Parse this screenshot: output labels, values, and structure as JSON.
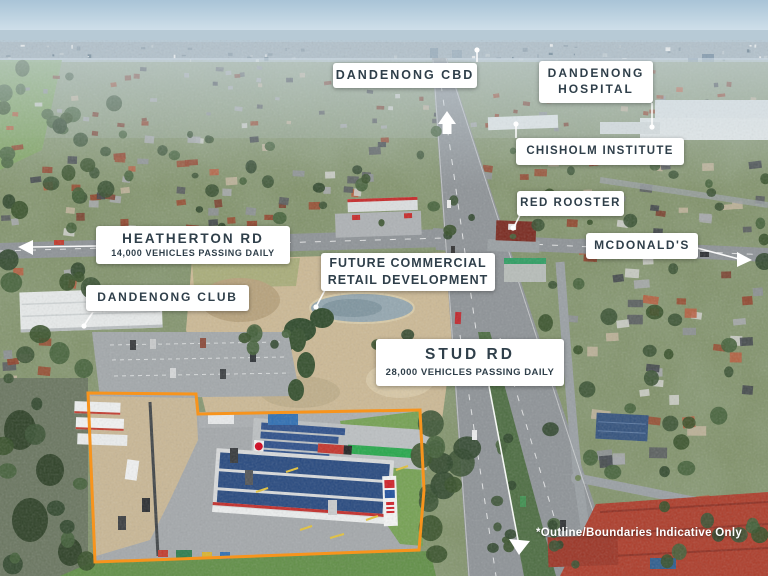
{
  "colors": {
    "boundary": "#F7941D",
    "label_bg": "#FFFFFF",
    "label_text": "#2F3F4A",
    "disclaimer_text": "#FFFFFF"
  },
  "labels": {
    "dandenong_cbd": {
      "text": "DANDENONG CBD"
    },
    "dandenong_hospital": {
      "line1": "DANDENONG",
      "line2": "HOSPITAL"
    },
    "chisholm_institute": {
      "text": "CHISHOLM INSTITUTE"
    },
    "red_rooster": {
      "text": "RED ROOSTER"
    },
    "mcdonalds": {
      "text": "MCDONALD'S"
    },
    "heatherton_rd": {
      "title": "HEATHERTON RD",
      "subtitle": "14,000 VEHICLES PASSING DAILY"
    },
    "dandenong_club": {
      "text": "DANDENONG CLUB"
    },
    "future_development": {
      "line1": "FUTURE COMMERCIAL",
      "line2": "RETAIL DEVELOPMENT"
    },
    "stud_rd": {
      "title": "STUD RD",
      "subtitle": "28,000 VEHICLES PASSING DAILY"
    }
  },
  "disclaimer": {
    "text": "*Outline/Boundaries Indicative Only"
  }
}
